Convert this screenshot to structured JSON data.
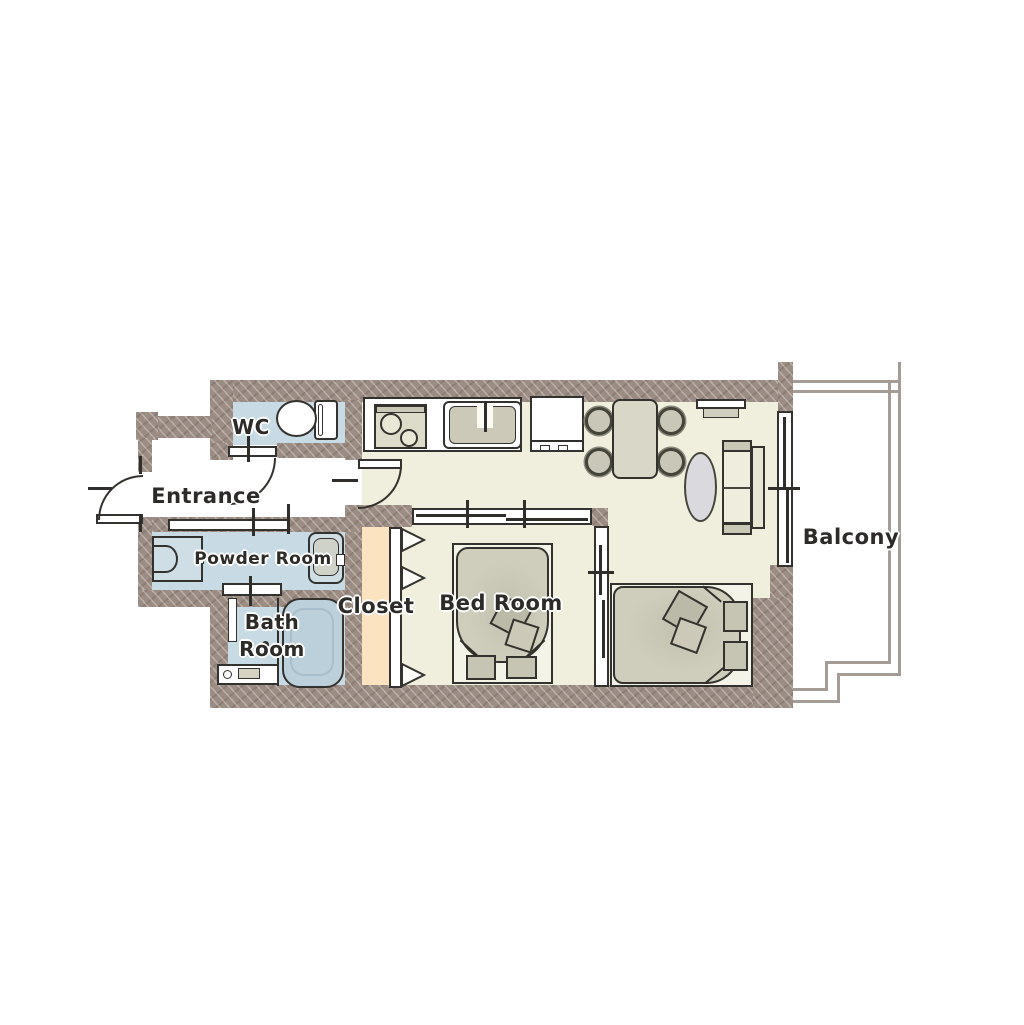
{
  "title": "Apartment floor plan",
  "colors": {
    "wall": "#9c8d84",
    "floor_main": "#f0efde",
    "floor_wet_rooms": "#c8dbe4",
    "floor_closet": "#fbe3bf",
    "outline": "#33322e",
    "furniture_gray": "#cfcdbc",
    "balcony_line": "#a59c96"
  },
  "rooms": {
    "wc": {
      "label": "WC"
    },
    "entrance": {
      "label": "Entrance"
    },
    "powder_room": {
      "label": "Powder Room"
    },
    "bath_room": {
      "label_line1": "Bath",
      "label_line2": "Room"
    },
    "closet": {
      "label": "Closet"
    },
    "bed_room": {
      "label": "Bed Room"
    },
    "balcony": {
      "label": "Balcony"
    }
  }
}
